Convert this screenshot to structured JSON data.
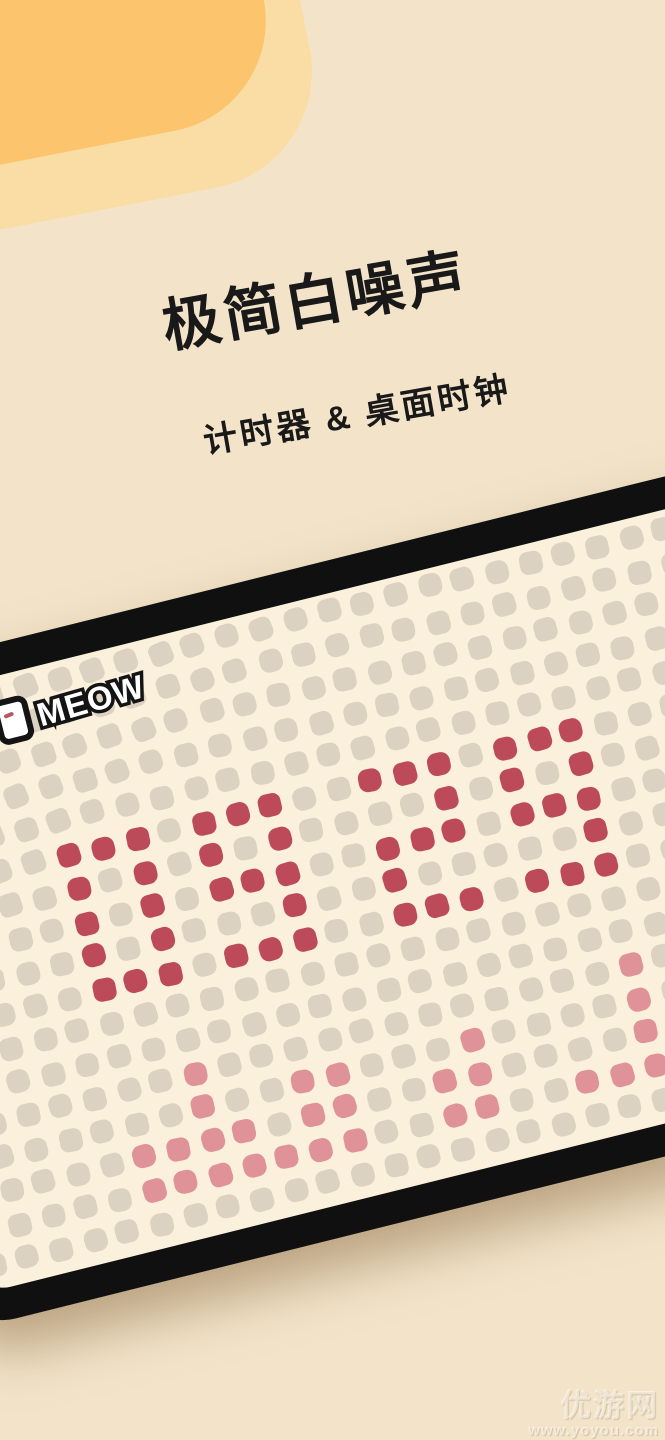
{
  "hero": {
    "title": "极简白噪声",
    "subtitle": "计时器 & 桌面时钟"
  },
  "device": {
    "logo_text": "MEOW"
  },
  "clock": {
    "time_shown": "09 29",
    "chart_note": "dot-matrix clock display, digits 0-9 drawn as 3x5 dot glyphs",
    "grid": {
      "col_start": -5,
      "col_end": 19,
      "row_start": -5,
      "row_end": 11,
      "pitch": 34.5,
      "dot_size": 23,
      "origin_x": 190,
      "origin_y": 192
    },
    "active_cells": [
      [
        0,
        0
      ],
      [
        1,
        0
      ],
      [
        2,
        0
      ],
      [
        0,
        1
      ],
      [
        2,
        1
      ],
      [
        0,
        2
      ],
      [
        2,
        2
      ],
      [
        0,
        3
      ],
      [
        2,
        3
      ],
      [
        0,
        4
      ],
      [
        1,
        4
      ],
      [
        2,
        4
      ],
      [
        4,
        0
      ],
      [
        5,
        0
      ],
      [
        6,
        0
      ],
      [
        4,
        1
      ],
      [
        6,
        1
      ],
      [
        4,
        2
      ],
      [
        5,
        2
      ],
      [
        6,
        2
      ],
      [
        6,
        3
      ],
      [
        4,
        4
      ],
      [
        5,
        4
      ],
      [
        6,
        4
      ],
      [
        9,
        0
      ],
      [
        10,
        0
      ],
      [
        11,
        0
      ],
      [
        11,
        1
      ],
      [
        9,
        2
      ],
      [
        10,
        2
      ],
      [
        11,
        2
      ],
      [
        9,
        3
      ],
      [
        9,
        4
      ],
      [
        10,
        4
      ],
      [
        11,
        4
      ],
      [
        13,
        0
      ],
      [
        14,
        0
      ],
      [
        15,
        0
      ],
      [
        13,
        1
      ],
      [
        15,
        1
      ],
      [
        13,
        2
      ],
      [
        14,
        2
      ],
      [
        15,
        2
      ],
      [
        15,
        3
      ],
      [
        13,
        4
      ],
      [
        14,
        4
      ],
      [
        15,
        4
      ]
    ],
    "faded_cells": [
      [
        2,
        7
      ],
      [
        2,
        8
      ],
      [
        5,
        8
      ],
      [
        6,
        8
      ],
      [
        10,
        8
      ],
      [
        15,
        7
      ],
      [
        15,
        8
      ],
      [
        0,
        9
      ],
      [
        1,
        9
      ],
      [
        2,
        9
      ],
      [
        3,
        9
      ],
      [
        5,
        9
      ],
      [
        6,
        9
      ],
      [
        9,
        9
      ],
      [
        10,
        9
      ],
      [
        15,
        9
      ],
      [
        0,
        10
      ],
      [
        1,
        10
      ],
      [
        2,
        10
      ],
      [
        3,
        10
      ],
      [
        4,
        10
      ],
      [
        5,
        10
      ],
      [
        6,
        10
      ],
      [
        9,
        10
      ],
      [
        10,
        10
      ],
      [
        13,
        10
      ],
      [
        14,
        10
      ],
      [
        15,
        10
      ]
    ]
  },
  "watermark": {
    "site_name": "优游网",
    "site_url": "www.yoyou.com"
  },
  "colors": {
    "background": "#F3E4C9",
    "orange_core": "#FBC46D",
    "orange_halo": "#F9DDA5",
    "ink": "#191919",
    "device_frame": "#101010",
    "screen": "#FBF0DB",
    "dot_idle": "#DCD2C1",
    "dot_active": "#BC4A58",
    "dot_faded": "#DF9298"
  }
}
